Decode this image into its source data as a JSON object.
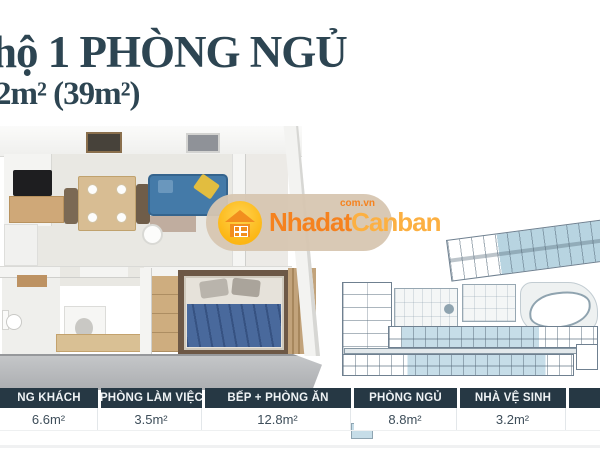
{
  "title": "hộ 1 PHÒNG NGỦ",
  "subtitle": "2m² (39m²)",
  "watermark": {
    "text_primary": "Nhadat",
    "text_secondary": "Canban",
    "domain": "com.vn",
    "colors": {
      "pill_bg": "#d7c6b1",
      "circle": "#fcb614",
      "text_primary": "#f5821f",
      "text_secondary": "#fcb042"
    }
  },
  "area_table": {
    "header_bg": "#263844",
    "header_text_color": "#eef2f4",
    "value_text_color": "#3e4e5a",
    "columns": [
      {
        "label": "NG KHÁCH",
        "value": "6.6m²"
      },
      {
        "label": "PHÒNG LÀM VIỆC",
        "value": "3.5m²"
      },
      {
        "label": "BẾP + PHÒNG ĂN",
        "value": "12.8m²"
      },
      {
        "label": "PHÒNG NGỦ",
        "value": "8.8m²"
      },
      {
        "label": "NHÀ VỆ SINH",
        "value": "3.2m²"
      },
      {
        "label": "",
        "value": ""
      }
    ]
  },
  "floor_plan": {
    "type": "3d-apartment-render",
    "highlight_colors": {
      "sofa": "#447aa8",
      "bed_blanket": "#49699c",
      "wood": "#d8bd93",
      "slab": "#b4b6b8"
    }
  },
  "site_plan": {
    "type": "building-master-plan",
    "unit_highlight_color": "#c6dde8",
    "outline_color": "#6f8090",
    "features": [
      "angled-tower-wing",
      "left-unit-block",
      "amenity-areas",
      "swimming-pool",
      "unit-bars",
      "corridor"
    ]
  }
}
